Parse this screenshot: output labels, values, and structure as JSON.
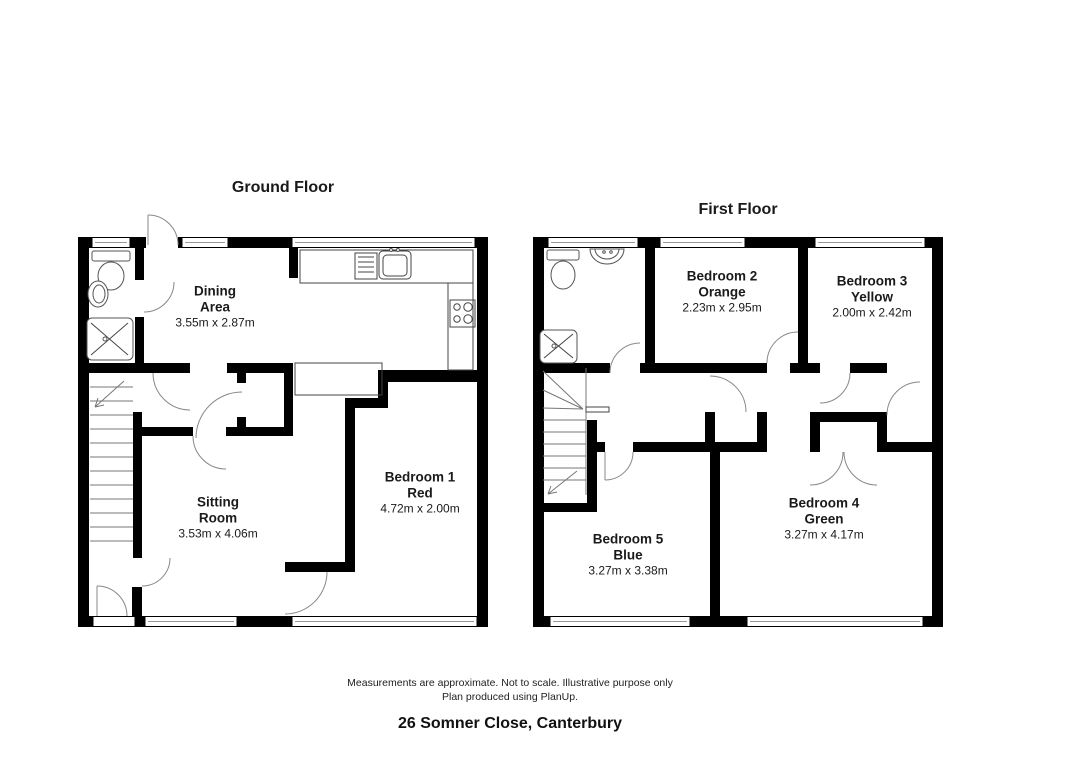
{
  "page": {
    "disclaimer_line1": "Measurements are approximate. Not to scale. Illustrative purpose only",
    "disclaimer_line2": "Plan produced using PlanUp.",
    "address": "26 Somner Close, Canterbury"
  },
  "floors": [
    {
      "title": "Ground Floor",
      "rooms": [
        {
          "name_line1": "Dining",
          "name_line2": "Area",
          "dims": "3.55m x 2.87m"
        },
        {
          "name_line1": "Sitting",
          "name_line2": "Room",
          "dims": "3.53m x 4.06m"
        },
        {
          "name_line1": "Bedroom 1",
          "name_line2": "Red",
          "dims": "4.72m x 2.00m"
        }
      ]
    },
    {
      "title": "First Floor",
      "rooms": [
        {
          "name_line1": "Bedroom 2",
          "name_line2": "Orange",
          "dims": "2.23m x 2.95m"
        },
        {
          "name_line1": "Bedroom 3",
          "name_line2": "Yellow",
          "dims": "2.00m x 2.42m"
        },
        {
          "name_line1": "Bedroom 5",
          "name_line2": "Blue",
          "dims": "3.27m x 3.38m"
        },
        {
          "name_line1": "Bedroom 4",
          "name_line2": "Green",
          "dims": "3.27m x 4.17m"
        }
      ]
    }
  ]
}
